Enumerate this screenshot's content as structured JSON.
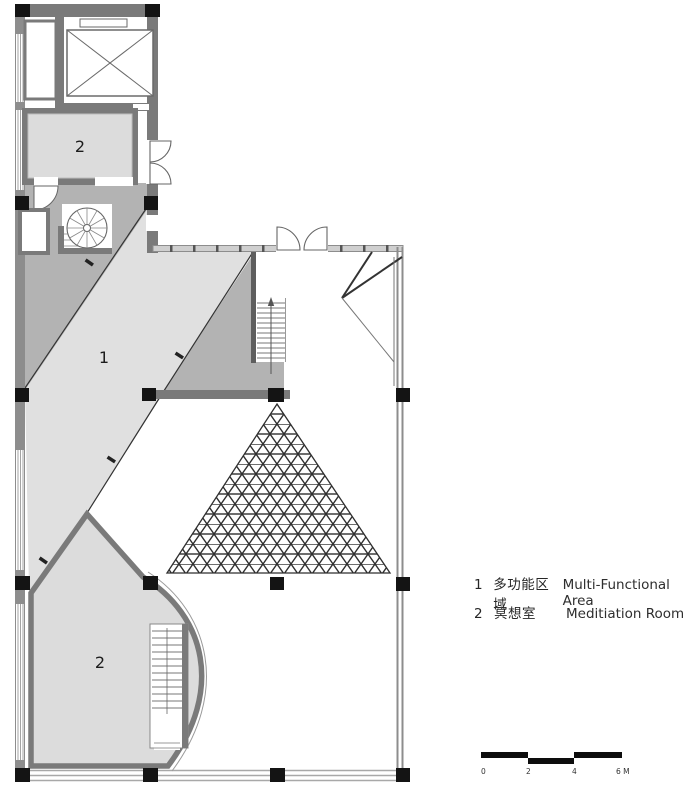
{
  "plan": {
    "area1_label": "1",
    "room2_top_label": "2",
    "room2_bottom_label": "2"
  },
  "legend": {
    "items": [
      {
        "num": "1",
        "zh": "多功能区域",
        "en": "Multi-Functional Area"
      },
      {
        "num": "2",
        "zh": "冥想室",
        "en": "Meditiation Room"
      }
    ]
  },
  "scale_bar": {
    "labels": [
      "0",
      "2",
      "4",
      "6 M"
    ]
  },
  "colors": {
    "wall": "#7a7a7a",
    "light_area": "#e0e0e0",
    "dark_area": "#b3b3b3",
    "room_fill": "#dcdcdc",
    "column": "#141414",
    "lattice": "#2f2f2f"
  }
}
